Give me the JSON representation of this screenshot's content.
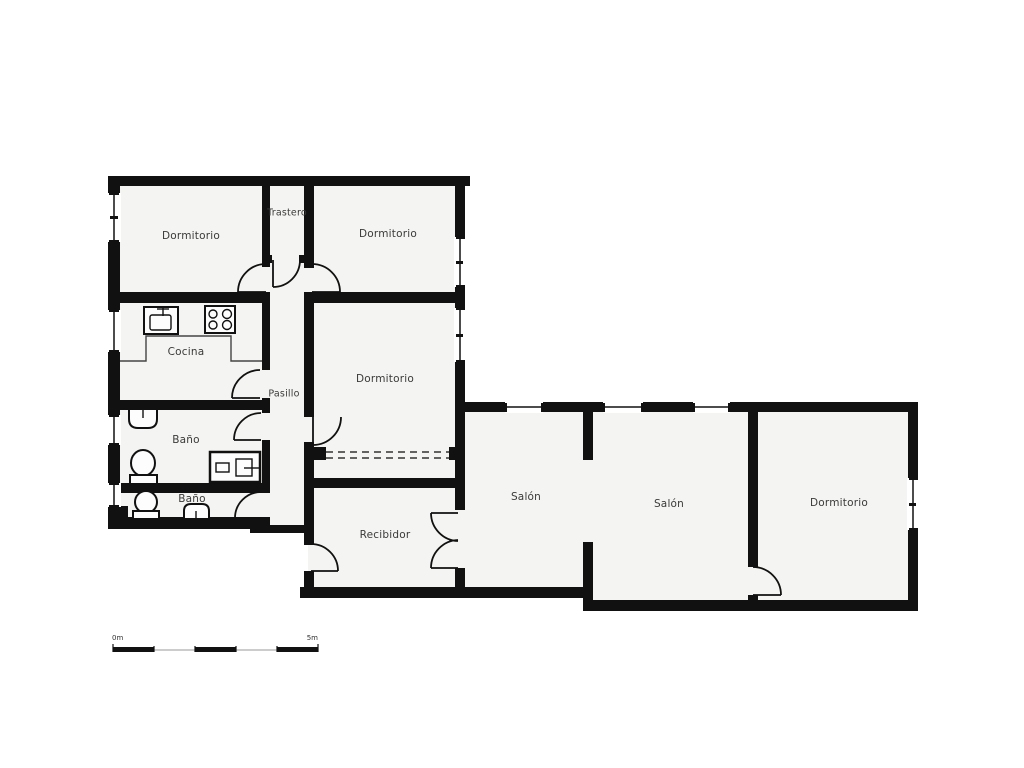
{
  "rooms": [
    {
      "id": "dormitorio-top-left",
      "label": "Dormitorio"
    },
    {
      "id": "trastero",
      "label": "Trastero"
    },
    {
      "id": "dormitorio-top-right",
      "label": "Dormitorio"
    },
    {
      "id": "cocina",
      "label": "Cocina"
    },
    {
      "id": "pasillo",
      "label": "Pasillo"
    },
    {
      "id": "dormitorio-middle",
      "label": "Dormitorio"
    },
    {
      "id": "bano-1",
      "label": "Baño"
    },
    {
      "id": "bano-2",
      "label": "Baño"
    },
    {
      "id": "recibidor",
      "label": "Recibidor"
    },
    {
      "id": "salon-1",
      "label": "Salón"
    },
    {
      "id": "salon-2",
      "label": "Salón"
    },
    {
      "id": "dormitorio-right",
      "label": "Dormitorio"
    }
  ],
  "scale_bar": {
    "start_label": "0m",
    "end_label": "5m"
  },
  "colors": {
    "wall": "#111111",
    "floor": "#f4f4f2",
    "background": "#ffffff",
    "label_text": "#3a3a3a",
    "scale_line": "#999999"
  }
}
